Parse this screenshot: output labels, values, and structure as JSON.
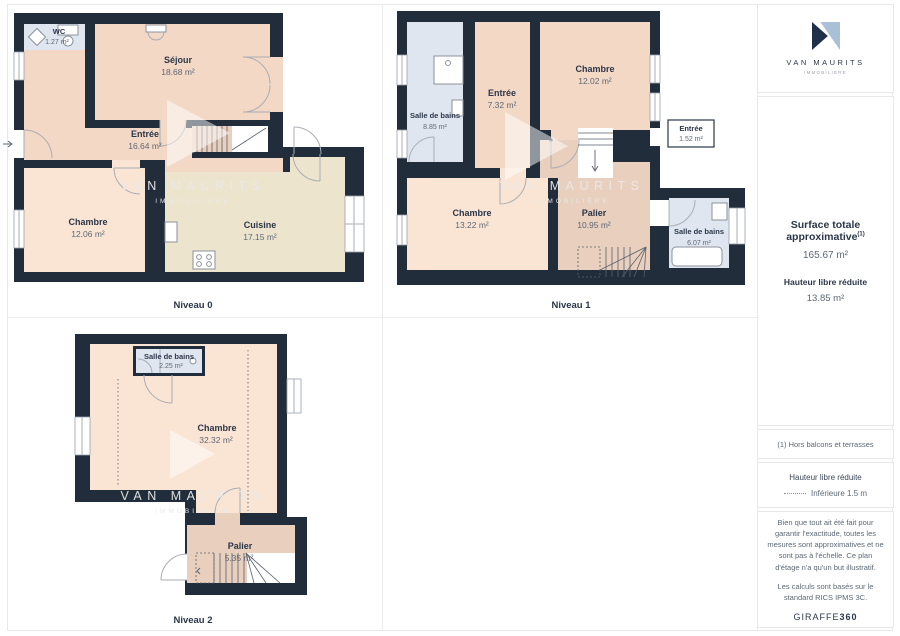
{
  "brand": {
    "name": "VAN MAURITS",
    "tagline": "IMMOBILIÈRE"
  },
  "watermark": {
    "line1": "VAN MAURITS",
    "line2": "IMMOBILIÈRE"
  },
  "plans": [
    {
      "label": "Niveau 0",
      "rooms": [
        {
          "name": "WC",
          "area": "1.27 m²"
        },
        {
          "name": "Séjour",
          "area": "18.68 m²"
        },
        {
          "name": "Entrée",
          "area": "16.64 m²"
        },
        {
          "name": "Chambre",
          "area": "12.06 m²"
        },
        {
          "name": "Cuisine",
          "area": "17.15 m²"
        }
      ]
    },
    {
      "label": "Niveau 1",
      "rooms": [
        {
          "name": "Salle de bains",
          "area": "8.85 m²"
        },
        {
          "name": "Entrée",
          "area": "7.32 m²"
        },
        {
          "name": "Chambre",
          "area": "12.02 m²"
        },
        {
          "name": "Entrée",
          "area": "1.52 m²"
        },
        {
          "name": "Chambre",
          "area": "13.22 m²"
        },
        {
          "name": "Palier",
          "area": "10.95 m²"
        },
        {
          "name": "Salle de bains",
          "area": "6.07 m²"
        }
      ]
    },
    {
      "label": "Niveau 2",
      "rooms": [
        {
          "name": "Salle de bains",
          "area": "2.25 m²"
        },
        {
          "name": "Chambre",
          "area": "32.32 m²"
        },
        {
          "name": "Palier",
          "area": "5.35 m²"
        }
      ]
    }
  ],
  "sidebar": {
    "surface_title": "Surface totale approximative",
    "surface_footnote_marker": "(1)",
    "surface_value": "165.67 m²",
    "reduced_height_label": "Hauteur libre réduite",
    "reduced_height_value": "13.85 m²",
    "footnote": "(1) Hors balcons et terrasses",
    "legend_title": "Hauteur libre réduite",
    "legend_item": "Inférieure 1.5 m",
    "disclaimer_1": "Bien que tout ait été fait pour garantir l'exactitude, toutes les mesures sont approximatives et ne sont pas à l'échelle. Ce plan d'étage n'a qu'un but illustratif.",
    "disclaimer_2": "Les calculs sont basés sur le standard RICS IPMS 3C.",
    "logo_text": "GIRAFFE",
    "logo_text_bold": "360"
  },
  "colors": {
    "wall": "#212d3b",
    "room_peach": "#f3d8c6",
    "room_peach_light": "#fae5d4",
    "room_tan": "#e9cfbd",
    "room_blue": "#e0e6f0",
    "room_beige": "#ece4cd",
    "text_navy": "#2b3648",
    "text_gray": "#5d6875",
    "logo_dark": "#20304a",
    "logo_light": "#a9c0d6"
  }
}
